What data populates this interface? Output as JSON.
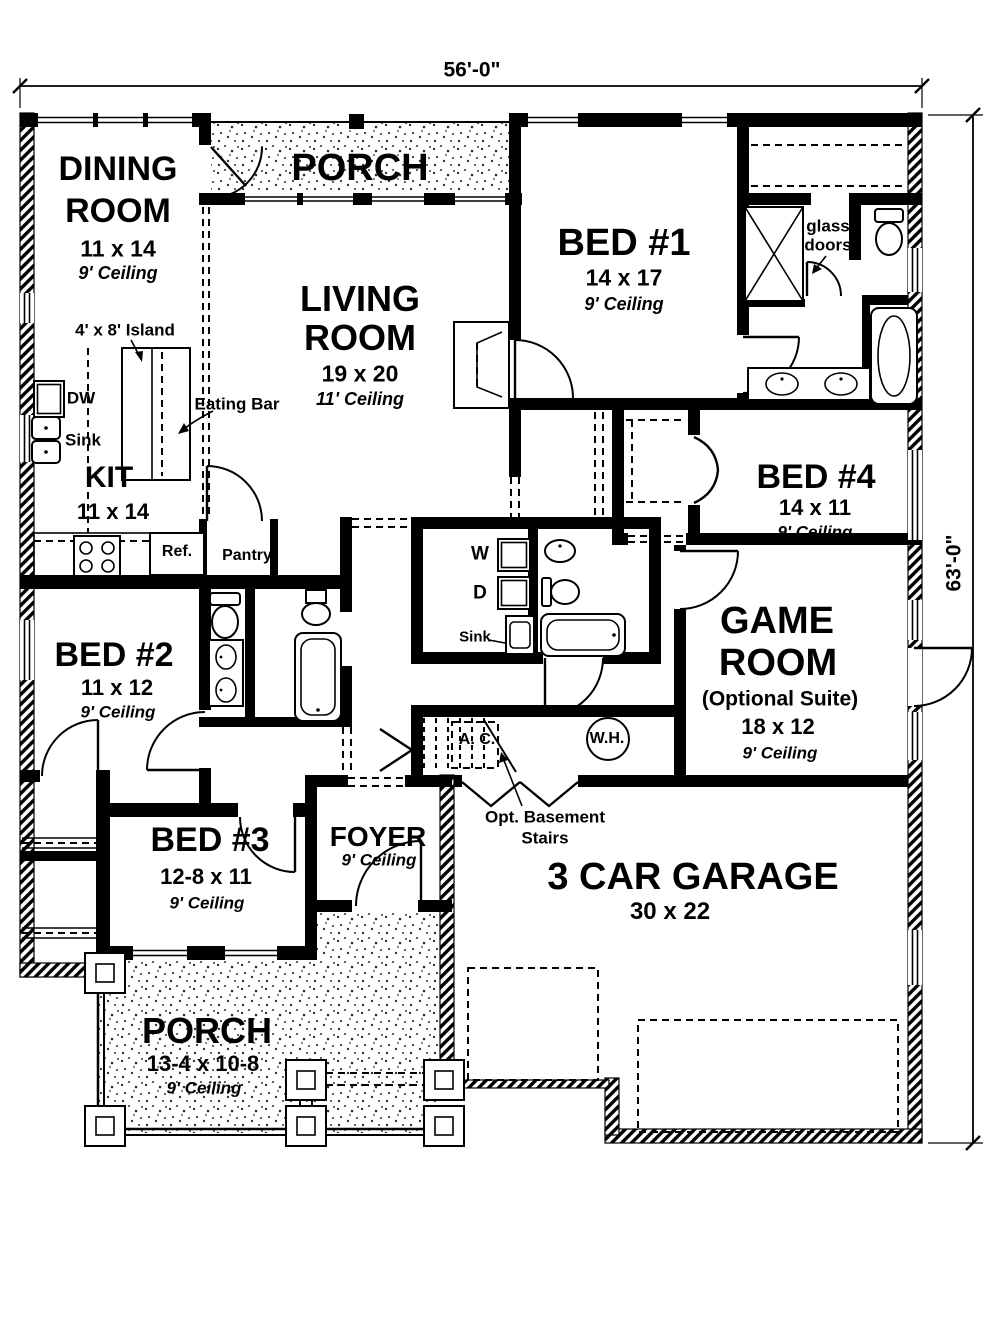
{
  "dimensions": {
    "width": "56'-0\"",
    "height": "63'-0\""
  },
  "rooms": {
    "dining": {
      "line1": "DINING",
      "line2": "ROOM",
      "size": "11 x 14",
      "ceiling": "9' Ceiling"
    },
    "porch_top": {
      "line1": "PORCH"
    },
    "living": {
      "line1": "LIVING",
      "line2": "ROOM",
      "size": "19 x 20",
      "ceiling": "11' Ceiling"
    },
    "bed1": {
      "line1": "BED #1",
      "size": "14 x 17",
      "ceiling": "9' Ceiling"
    },
    "kitchen": {
      "line1": "KIT",
      "size": "11 x 14"
    },
    "bed4": {
      "line1": "BED #4",
      "size": "14 x 11",
      "ceiling": "9' Ceiling"
    },
    "bed2": {
      "line1": "BED #2",
      "size": "11 x 12",
      "ceiling": "9' Ceiling"
    },
    "game": {
      "line1": "GAME",
      "line2": "ROOM",
      "line3": "(Optional Suite)",
      "size": "18 x 12",
      "ceiling": "9' Ceiling"
    },
    "bed3": {
      "line1": "BED #3",
      "size": "12-8 x 11",
      "ceiling": "9' Ceiling"
    },
    "foyer": {
      "line1": "FOYER",
      "ceiling": "9' Ceiling"
    },
    "garage": {
      "line1": "3 CAR GARAGE",
      "size": "30 x 22"
    },
    "porch_bottom": {
      "line1": "PORCH",
      "size": "13-4 x 10-8",
      "ceiling": "9' Ceiling"
    }
  },
  "fixtures": {
    "island": "4' x 8' Island",
    "eating_bar": "Eating Bar",
    "dishwasher": "DW",
    "kitchen_sink": "Sink",
    "refrigerator": "Ref.",
    "pantry": "Pantry",
    "washer": "W",
    "dryer": "D",
    "laundry_sink": "Sink",
    "glass_doors_line1": "glass",
    "glass_doors_line2": "doors",
    "ac_unit": "A. C.",
    "water_heater": "W.H.",
    "basement_line1": "Opt. Basement",
    "basement_line2": "Stairs"
  }
}
